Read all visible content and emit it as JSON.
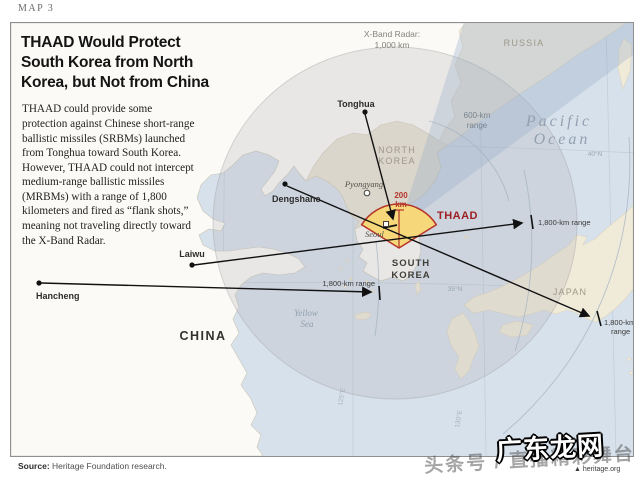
{
  "page": {
    "map_label": "MAP 3",
    "source_label": "Source:",
    "source_text": " Heritage Foundation research."
  },
  "infobox": {
    "title_line1": "THAAD Would Protect",
    "title_line2": "South Korea from North",
    "title_line3": "Korea, but Not from China",
    "body": "THAAD could provide some protection against Chinese short-range ballistic missiles (SRBMs) launched from Tonghua toward South Korea. However, THAAD could not intercept medium-range ballistic missiles (MRBMs) with a range of 1,800 kilometers and fired as “flank shots,” meaning not traveling directly toward the X-Band Radar."
  },
  "map": {
    "radar_label_line1": "X-Band Radar:",
    "radar_label_line2": "1,000 km",
    "countries": {
      "russia": "RUSSIA",
      "north_korea_line1": "NORTH",
      "north_korea_line2": "KOREA",
      "south_korea_line1": "SOUTH",
      "south_korea_line2": "KOREA",
      "china": "CHINA",
      "japan": "JAPAN"
    },
    "seas": {
      "pacific_line1": "Pacific",
      "pacific_line2": "Ocean",
      "yellow_line1": "Yellow",
      "yellow_line2": "Sea"
    },
    "cities": {
      "tonghua": "Tonghua",
      "dengshahe": "Dengshahe",
      "laiwu": "Laiwu",
      "hancheng": "Hancheng",
      "pyongyang": "Pyongyang",
      "seoul": "Seoul"
    },
    "thaad": "THAAD",
    "ranges": {
      "r200_line1": "200",
      "r200_line2": "km",
      "r600_line1": "600-km",
      "r600_line2": "range",
      "r1800_east": "1,800-km range",
      "r1800_west": "1,800-km range",
      "r1800_japan_line1": "1,800-km",
      "r1800_japan_line2": "range"
    },
    "graticule": {
      "lat40": "40°N",
      "lat35": "35°N",
      "lon130": "130°E",
      "lon125": "125°E"
    }
  },
  "watermark": {
    "main": "广东龙网",
    "sub": "头条号 / 直播精彩舞台",
    "org": "heritage.org"
  },
  "colors": {
    "sea": "#d7e1eb",
    "china_land": "#fbfaf6",
    "north_korea_land": "#e9e3d3",
    "russia_land": "#f0ebdc",
    "japan_land": "#f0ead9",
    "thaad_fan_fill": "#f6d87b",
    "thaad_fan_border": "#b5352b",
    "thaad_text": "#9c1f23",
    "missile_line": "#111111",
    "radar_overlay": "#b0b0b3",
    "wedge_overlay": "#96aac6"
  }
}
